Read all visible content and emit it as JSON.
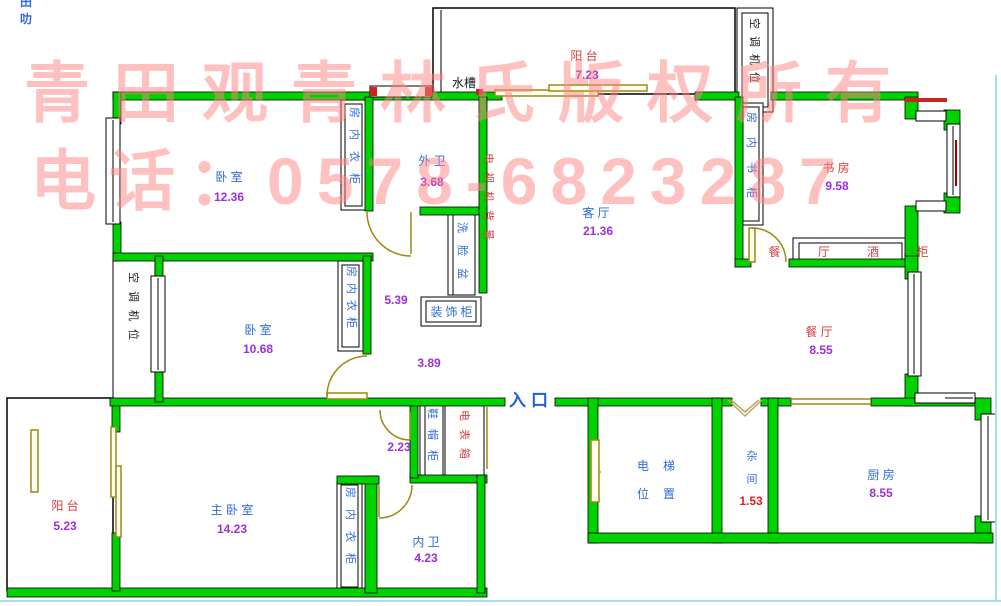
{
  "watermark": {
    "line1": "青田观青林氏版权所有",
    "line2": "电话：0578-6823287"
  },
  "corner_marks": {
    "glyph_top": "田",
    "glyph_bottom": "叻"
  },
  "rooms": {
    "balcony_top": {
      "name": "阳 台",
      "area": "7.23"
    },
    "bedroom1": {
      "name": "卧 室",
      "area": "12.36"
    },
    "outer_bath": {
      "name": "外 卫",
      "area": "3.68"
    },
    "living_room": {
      "name": "客 厅",
      "area": "21.36"
    },
    "study": {
      "name": "书 房",
      "area": "9.58"
    },
    "bedroom2": {
      "name": "卧 室",
      "area": "10.68"
    },
    "dining": {
      "name": "餐 厅",
      "area": "8.55"
    },
    "master_bedroom": {
      "name": "主 卧 室",
      "area": "14.23"
    },
    "balcony_bottom": {
      "name": "阳 台",
      "area": "5.23"
    },
    "inner_bath": {
      "name": "内 卫",
      "area": "4.23"
    },
    "kitchen": {
      "name": "厨 房",
      "area": "8.55"
    },
    "utility": {
      "name": "杂间",
      "area": "1.53"
    },
    "elevator": {
      "line1": "电梯",
      "line2": "位置"
    }
  },
  "fixtures": {
    "sink": "水槽",
    "wardrobe": "房内衣柜",
    "bookcase": "房内书柜",
    "wine_cabinet": "餐 厅 酒 柜",
    "tv_wall": "电视机背景",
    "wash_basin": "洗脸盆",
    "deco_cabinet": "装饰柜",
    "ac_position": "空调机位",
    "shoe_cabinet": "鞋帽柜",
    "meter_box": "电表箱",
    "entrance": "入口"
  },
  "dimensions": {
    "hall_width": "5.39",
    "corridor": "3.89",
    "entry_width": "2.23"
  },
  "colors": {
    "wall_green": "#00d200",
    "label_blue": "#2e6bd9",
    "number_purple": "#9b30d9",
    "label_red": "#d34040",
    "number_red": "#e02020",
    "door_olive": "#9c8a10",
    "watermark_pink": "#ff8282",
    "frame_cyan": "#aadcec"
  }
}
